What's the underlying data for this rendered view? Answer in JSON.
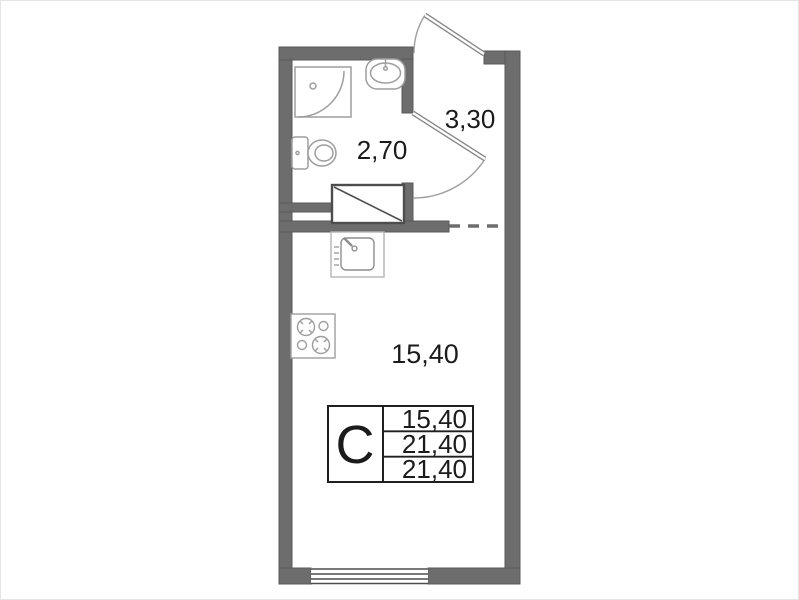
{
  "floor_plan": {
    "description": "studio apartment floor plan",
    "rooms": [
      {
        "id": "bathroom",
        "area_label": "2,70"
      },
      {
        "id": "hallway",
        "area_label": "3,30"
      },
      {
        "id": "main-room",
        "area_label": "15,40"
      }
    ],
    "info_table": {
      "unit_type_label": "С",
      "values": [
        "15,40",
        "21,40",
        "21,40"
      ]
    },
    "fixtures": [
      "shower-tray",
      "bathroom-sink",
      "toilet",
      "wardrobe",
      "kitchen-sink",
      "stove",
      "window",
      "entry-door",
      "bathroom-door"
    ],
    "colors": {
      "wall": "#6d6d6d",
      "wall_edge": "#595959",
      "fixture_stroke": "#9e9e9e",
      "door_stroke": "#858585",
      "dark_line": "#4d4d4d",
      "table_border": "#1f1f1f",
      "text": "#1b1b1b"
    }
  }
}
